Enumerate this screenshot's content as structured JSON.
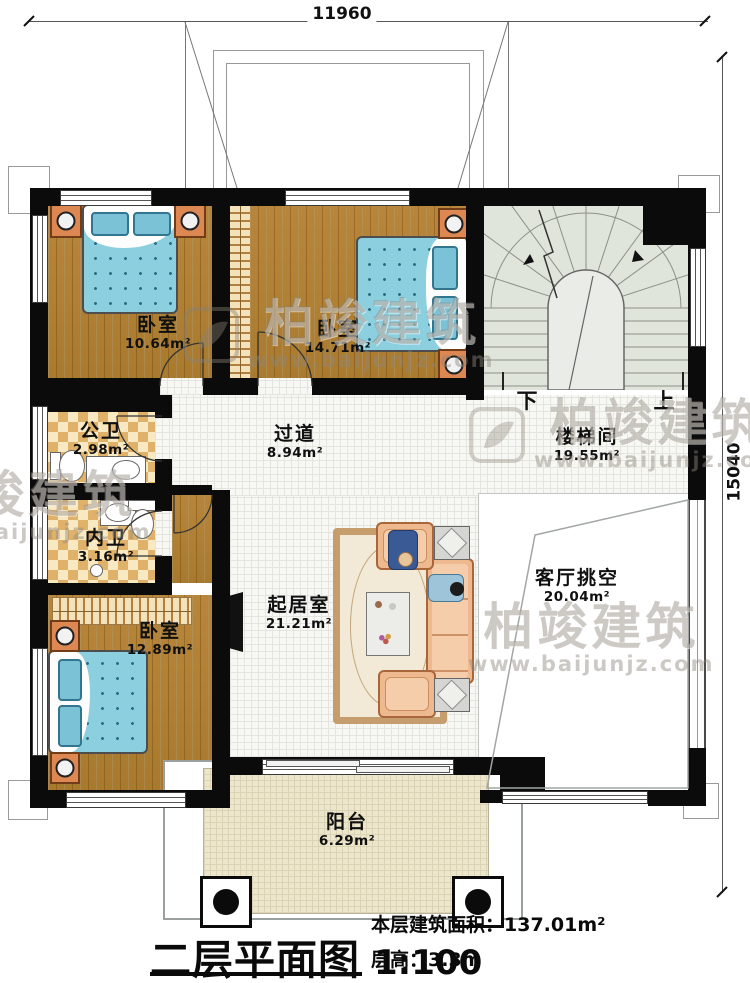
{
  "dimensions": {
    "top": "11960",
    "right": "15040"
  },
  "rooms": [
    {
      "id": "bedroom-1",
      "name": "卧室",
      "area": "10.64m²"
    },
    {
      "id": "bedroom-2",
      "name": "卧室",
      "area": "14.71m²"
    },
    {
      "id": "stairwell",
      "name": "楼梯间",
      "area": "19.55m²"
    },
    {
      "id": "corridor",
      "name": "过道",
      "area": "8.94m²"
    },
    {
      "id": "public-bathroom",
      "name": "公卫",
      "area": "2.98m²"
    },
    {
      "id": "ensuite-bathroom",
      "name": "内卫",
      "area": "3.16m²"
    },
    {
      "id": "bedroom-3",
      "name": "卧室",
      "area": "12.89m²"
    },
    {
      "id": "living-room",
      "name": "起居室",
      "area": "21.21m²"
    },
    {
      "id": "living-void",
      "name": "客厅挑空",
      "area": "20.04m²"
    },
    {
      "id": "balcony",
      "name": "阳台",
      "area": "6.29m²"
    }
  ],
  "stairs": {
    "down": "下",
    "up": "上"
  },
  "title": {
    "text": "二层平面图",
    "scale": "1:100"
  },
  "info": {
    "area": "本层建筑面积：137.01m²",
    "floor_height": "层高：3.3m"
  },
  "watermark": {
    "brand": "柏竣建筑",
    "url": "www.baijunjz.com"
  },
  "colors": {
    "wall": "#0b0b0b",
    "wood": "#b07f33",
    "tile": "#f7f7f3",
    "bath_tile": "#f6e3b4",
    "stair_floor": "#e0e5dc",
    "balcony_floor": "#ece6cd",
    "bed_blue": "#8ccfdf",
    "furniture_orange": "#dd8852",
    "sofa_peach": "#efb990"
  }
}
